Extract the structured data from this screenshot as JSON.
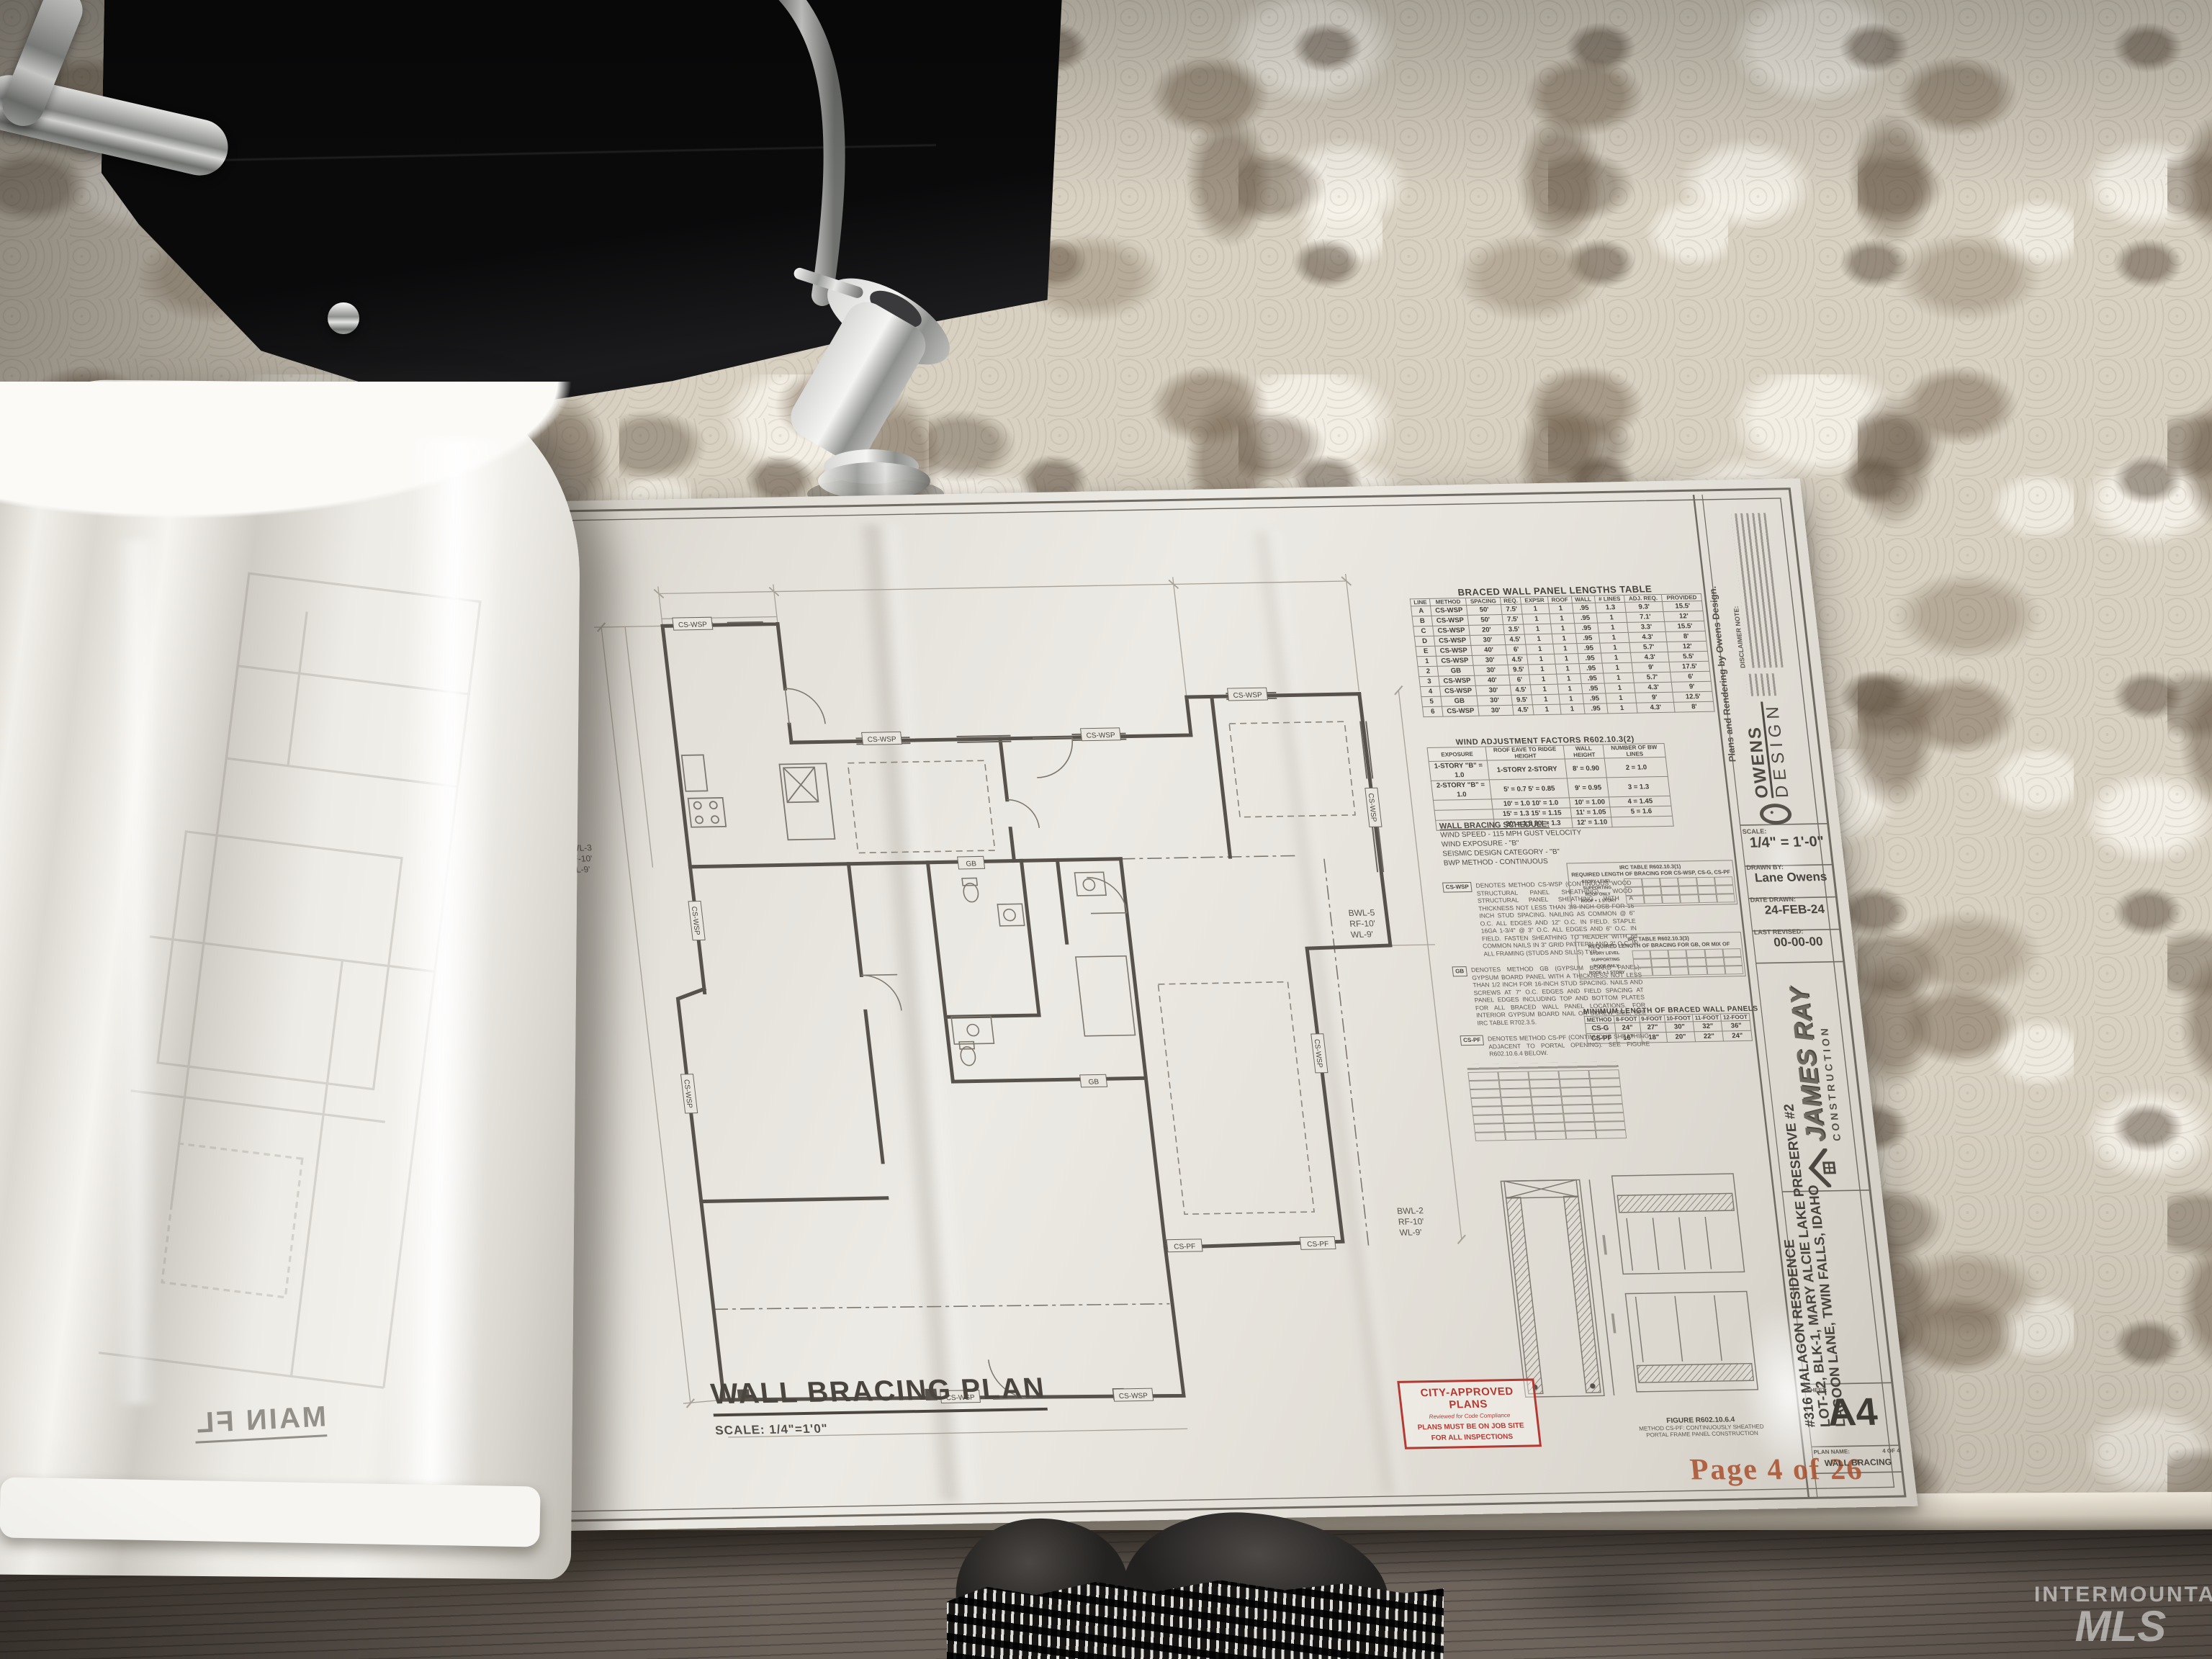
{
  "watermark": {
    "brand": "INTERMOUNTAIN",
    "mls": "MLS"
  },
  "mirrored_sheet_title": "MAIN FL",
  "plan": {
    "title": "WALL BRACING PLAN",
    "scale": "SCALE: 1/4\"=1'0\"",
    "page_marker": "Page 4 of 26",
    "tags": {
      "cswsp": "CS-WSP",
      "gb": "GB",
      "cspf": "CS-PF"
    },
    "annotations": {
      "right_top": [
        "BWL-5",
        "RF-10'",
        "WL-9'"
      ],
      "right_bottom": [
        "BWL-2",
        "RF-10'",
        "WL-9'"
      ],
      "left": [
        "BWL-3",
        "RF-10'",
        "WL-9'"
      ]
    }
  },
  "stamp": {
    "line1": "CITY-APPROVED PLANS",
    "line2": "Reviewed for Code Compliance",
    "line3": "PLANS MUST BE ON JOB SITE",
    "line4": "FOR ALL INSPECTIONS"
  },
  "braced_table": {
    "title": "BRACED WALL PANEL LENGTHS TABLE",
    "headers": [
      "LINE",
      "METHOD",
      "SPACING",
      "REQ.",
      "EXPSR",
      "ROOF",
      "WALL",
      "# LINES",
      "ADJ. REQ.",
      "PROVIDED"
    ],
    "rows": [
      [
        "A",
        "CS-WSP",
        "50'",
        "7.5'",
        "1",
        "1",
        ".95",
        "1.3",
        "9.3'",
        "15.5'"
      ],
      [
        "B",
        "CS-WSP",
        "50'",
        "7.5'",
        "1",
        "1",
        ".95",
        "1",
        "7.1'",
        "12'"
      ],
      [
        "C",
        "CS-WSP",
        "20'",
        "3.5'",
        "1",
        "1",
        ".95",
        "1",
        "3.3'",
        "15.5'"
      ],
      [
        "D",
        "CS-WSP",
        "30'",
        "4.5'",
        "1",
        "1",
        ".95",
        "1",
        "4.3'",
        "8'"
      ],
      [
        "E",
        "CS-WSP",
        "40'",
        "6'",
        "1",
        "1",
        ".95",
        "1",
        "5.7'",
        "12'"
      ],
      [
        "1",
        "CS-WSP",
        "30'",
        "4.5'",
        "1",
        "1",
        ".95",
        "1",
        "4.3'",
        "5.5'"
      ],
      [
        "2",
        "GB",
        "30'",
        "9.5'",
        "1",
        "1",
        ".95",
        "1",
        "9'",
        "17.5'"
      ],
      [
        "3",
        "CS-WSP",
        "40'",
        "6'",
        "1",
        "1",
        ".95",
        "1",
        "5.7'",
        "6'"
      ],
      [
        "4",
        "CS-WSP",
        "30'",
        "4.5'",
        "1",
        "1",
        ".95",
        "1",
        "4.3'",
        "9'"
      ],
      [
        "5",
        "GB",
        "30'",
        "9.5'",
        "1",
        "1",
        ".95",
        "1",
        "9'",
        "12.5'"
      ],
      [
        "6",
        "CS-WSP",
        "30'",
        "4.5'",
        "1",
        "1",
        ".95",
        "1",
        "4.3'",
        "8'"
      ]
    ]
  },
  "wind_table": {
    "title": "WIND ADJUSTMENT FACTORS R602.10.3(2)",
    "headers": [
      "EXPOSURE",
      "ROOF EAVE TO RIDGE HEIGHT",
      "WALL HEIGHT",
      "NUMBER OF BW LINES"
    ],
    "rows": [
      [
        "1-STORY \"B\" = 1.0",
        "1-STORY    2-STORY",
        "8' = 0.90",
        "2 = 1.0"
      ],
      [
        "2-STORY \"B\" = 1.0",
        "5' = 0.7     5' = 0.85",
        "9' = 0.95",
        "3 = 1.3"
      ],
      [
        "",
        "10' = 1.0    10' = 1.0",
        "10' = 1.00",
        "4 = 1.45"
      ],
      [
        "",
        "15' = 1.3    15' = 1.15",
        "11' = 1.05",
        "5 = 1.6"
      ],
      [
        "",
        "20' = 1.5    20' = 1.3",
        "12' = 1.10",
        ""
      ]
    ]
  },
  "schedule": {
    "title": "WALL BRACING SCHEDULE:",
    "lines": [
      "WIND SPEED - 115 MPH GUST VELOCITY",
      "WIND EXPOSURE - \"B\"",
      "SEISMIC DESIGN CATEGORY - \"B\"",
      "BWP METHOD - CONTINUOUS"
    ]
  },
  "notes": [
    {
      "tag": "CS-WSP",
      "text": "DENOTES METHOD CS-WSP (CONTINUOUS WOOD STRUCTURAL PANEL SHEATHING). WOOD STRUCTURAL PANEL SHEATHING WITH A THICKNESS NOT LESS THAN 3/8 INCH OSB FOR 16 INCH STUD SPACING. NAILING AS COMMON @ 6\" O.C. ALL EDGES AND 12\" O.C. IN FIELD. STAPLE 16GA 1-3/4\" @ 3\" O.C. ALL EDGES AND 6\" O.C. IN FIELD. FASTEN SHEATHING TO HEADER WITH 8d COMMON NAILS IN 3\" GRID PATTERN AND 3\" O.C. IN ALL FRAMING (STUDS AND SILLS) TYP."
    },
    {
      "tag": "GB",
      "text": "DENOTES METHOD GB (GYPSUM BOARD PANEL). GYPSUM BOARD PANEL WITH A THICKNESS NOT LESS THAN 1/2 INCH FOR 16-INCH STUD SPACING. NAILS AND SCREWS AT 7\" O.C. EDGES AND FIELD SPACING AT PANEL EDGES INCLUDING TOP AND BOTTOM PLATES FOR ALL BRACED WALL PANEL LOCATIONS. FOR INTERIOR GYPSUM BOARD NAIL OR SCREW SIZE, SEE IRC TABLE R702.3.5."
    },
    {
      "tag": "CS-PF",
      "text": "DENOTES METHOD CS-PF (CONTINUOUS SHEATHING ADJACENT TO PORTAL OPENING). SEE FIGURE R602.10.6.4 BELOW."
    }
  ],
  "irc_tables": [
    {
      "line1": "IRC TABLE R602.10.3(1)",
      "line2": "REQUIRED LENGTH OF BRACING FOR CS-WSP, CS-G, CS-PF",
      "col_label": "STORY LEVEL SUPPORTING",
      "rows": [
        "ROOF ONLY",
        "ROOF + 1 STORY"
      ]
    },
    {
      "line1": "IRC TABLE R602.10.3(3)",
      "line2": "REQUIRED LENGTH OF BRACING FOR GB, OR MIX OF",
      "col_label": "STORY LEVEL SUPPORTING",
      "rows": [
        "ROOF ONLY",
        "ROOF + 1 STORY"
      ]
    }
  ],
  "min_table": {
    "title": "MINIMUM LENGTH OF BRACED WALL PANELS",
    "headers": [
      "METHOD",
      "8-FOOT",
      "9-FOOT",
      "10-FOOT",
      "11-FOOT",
      "12-FOOT"
    ],
    "rows": [
      [
        "CS-G",
        "24\"",
        "27\"",
        "30\"",
        "32\"",
        "36\""
      ],
      [
        "CS-PF",
        "16\"",
        "18\"",
        "20\"",
        "22\"",
        "24\""
      ]
    ]
  },
  "figure_caption": {
    "l1": "FIGURE R602.10.6.4",
    "l2": "METHOD CS-PF: CONTINUOUSLY SHEATHED",
    "l3": "PORTAL FRAME PANEL CONSTRUCTION"
  },
  "titleblock": {
    "credit": "Plans and Rendering by Owens Design.",
    "disclaimer_label": "DISCLAIMER NOTE:",
    "owens": {
      "line1": "OWENS",
      "line2": "DESIGN"
    },
    "fields": [
      {
        "label": "SCALE:",
        "value": "1/4\" = 1'-0\""
      },
      {
        "label": "DRAWN BY:",
        "value": "Lane Owens"
      },
      {
        "label": "DATE DRAWN:",
        "value": "24-FEB-24"
      },
      {
        "label": "LAST REVISED:",
        "value": "00-00-00"
      }
    ],
    "james_ray": {
      "line1": "JAMES RAY",
      "line2": "CONSTRUCTION"
    },
    "project": [
      "#316 MALAGON RESIDENCE",
      "LOT-12, BLK-1, MARY ALCIE LAKE PRESERVE #2",
      "LAGOON LANE, TWIN FALLS, IDAHO"
    ],
    "sheet_label": "SHEET:",
    "sheet_number": "A4",
    "plan_name_label": "PLAN NAME:",
    "plan_name": "WALL BRACING",
    "pages": "4 OF 4"
  }
}
